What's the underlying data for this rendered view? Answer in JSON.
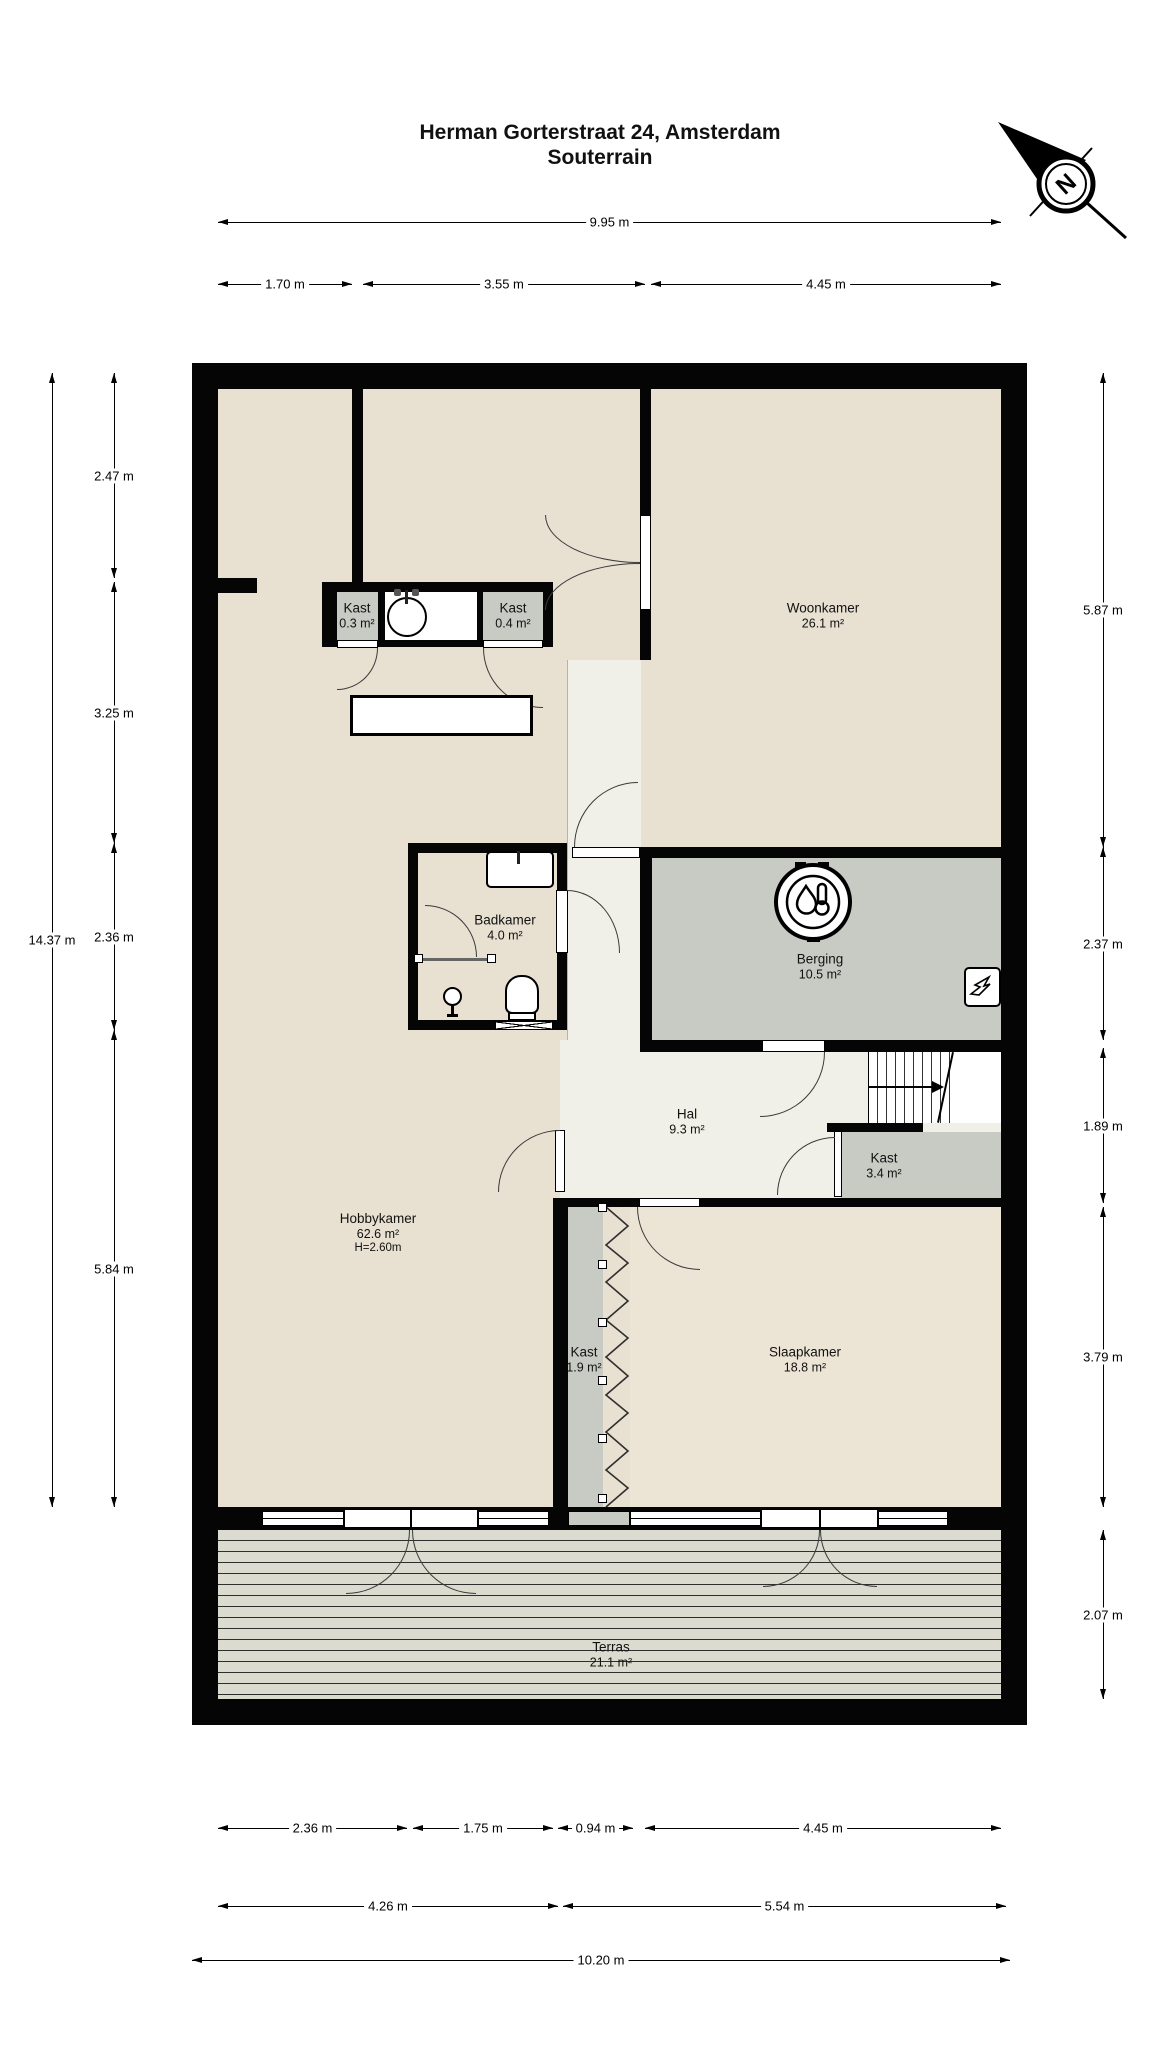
{
  "title": {
    "address": "Herman Gorterstraat 24, Amsterdam",
    "floor": "Souterrain"
  },
  "compass": {
    "north_label": "N"
  },
  "rooms": [
    {
      "name": "Woonkamer",
      "area": "26.1 m²"
    },
    {
      "name": "Kast",
      "area": "0.3 m²"
    },
    {
      "name": "Kast",
      "area": "0.4 m²"
    },
    {
      "name": "Badkamer",
      "area": "4.0 m²"
    },
    {
      "name": "Berging",
      "area": "10.5 m²"
    },
    {
      "name": "Hal",
      "area": "9.3 m²"
    },
    {
      "name": "Kast",
      "area": "3.4 m²"
    },
    {
      "name": "Hobbykamer",
      "area": "62.6 m²",
      "height": "H=2.60m"
    },
    {
      "name": "Kast",
      "area": "1.9 m²"
    },
    {
      "name": "Slaapkamer",
      "area": "18.8 m²"
    },
    {
      "name": "Terras",
      "area": "21.1 m²"
    }
  ],
  "dimensions": {
    "top": {
      "overall": "9.95 m",
      "segments": [
        "1.70 m",
        "3.55 m",
        "4.45 m"
      ]
    },
    "left": {
      "overall": "14.37 m",
      "segments": [
        "2.47 m",
        "3.25 m",
        "2.36 m",
        "5.84 m"
      ]
    },
    "right": {
      "segments": [
        "5.87 m",
        "2.37 m",
        "1.89 m",
        "3.79 m",
        "2.07 m"
      ]
    },
    "bottom": {
      "overall": "10.20 m",
      "row1": [
        "2.36 m",
        "1.75 m",
        "0.94 m",
        "4.45 m"
      ],
      "row2": [
        "4.26 m",
        "5.54 m"
      ]
    }
  },
  "colors": {
    "wall": "#050505",
    "floor_beige": "#e8e0d1",
    "floor_gray": "#c7cbc4",
    "floor_hal": "#f0efe8",
    "floor_slaapkamer": "#ece5d6",
    "terras_deck": "#dcdbcf"
  }
}
